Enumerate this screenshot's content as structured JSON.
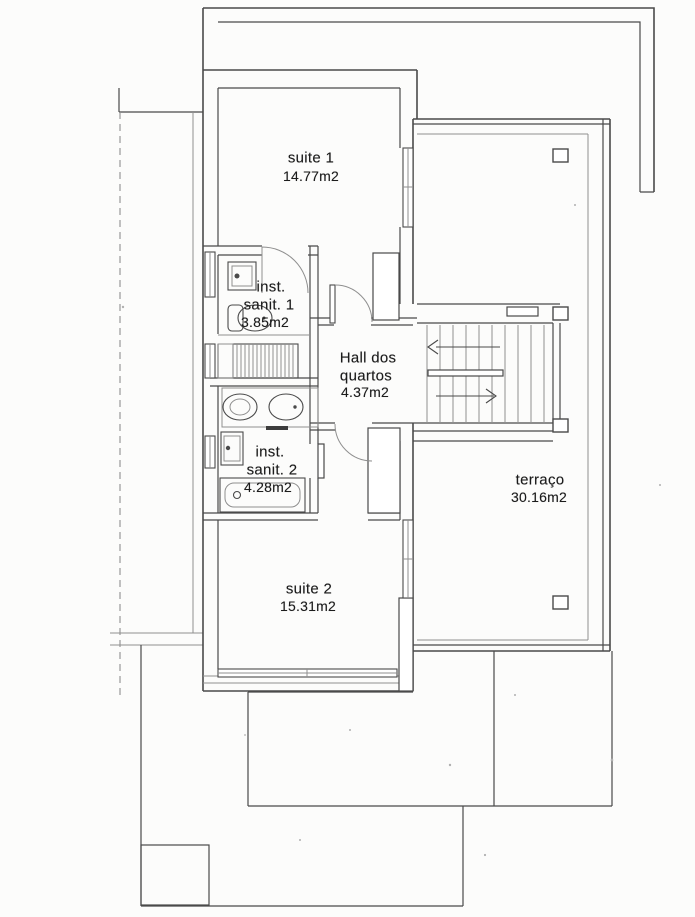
{
  "colors": {
    "wall": "#4a4a4a",
    "thin": "#8f8f8f",
    "text": "#1c1c1c",
    "paper": "#fcfcfb",
    "noise": "#b0b0b0"
  },
  "rooms": {
    "suite1": {
      "name": "suite 1",
      "area": "14.77m2"
    },
    "sanit1": {
      "line1": "inst.",
      "line2": "sanit. 1",
      "area": "3.85m2"
    },
    "hall": {
      "line1": "Hall dos",
      "line2": "quartos",
      "area": "4.37m2"
    },
    "sanit2": {
      "line1": "inst.",
      "line2": "sanit. 2",
      "area": "4.28m2"
    },
    "suite2": {
      "name": "suite 2",
      "area": "15.31m2"
    },
    "terraco": {
      "name": "terraço",
      "area": "30.16m2"
    }
  }
}
